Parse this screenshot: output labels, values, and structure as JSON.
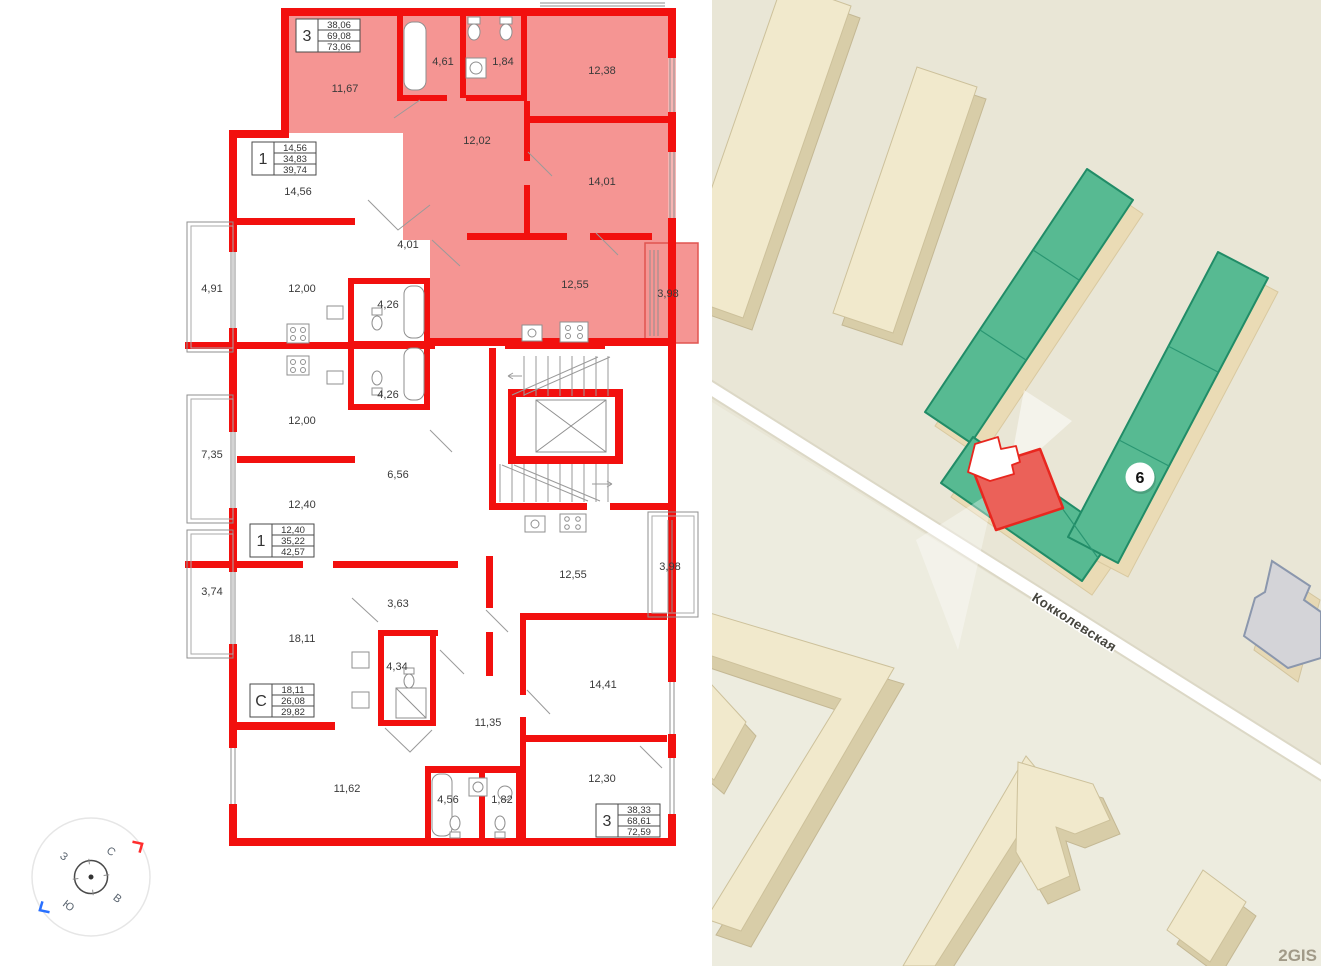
{
  "floorplan": {
    "colors": {
      "wall": "#f2100e",
      "selected_fill": "#f59593"
    },
    "summary_boxes": [
      {
        "type": "3",
        "rows": [
          "38,06",
          "69,08",
          "73,06"
        ]
      },
      {
        "type": "1",
        "rows": [
          "14,56",
          "34,83",
          "39,74"
        ]
      },
      {
        "type": "1",
        "rows": [
          "12,40",
          "35,22",
          "42,57"
        ]
      },
      {
        "type": "С",
        "rows": [
          "18,11",
          "26,08",
          "29,82"
        ]
      },
      {
        "type": "3",
        "rows": [
          "38,33",
          "68,61",
          "72,59"
        ]
      }
    ],
    "rooms": [
      "11,67",
      "4,61",
      "1,84",
      "12,38",
      "12,02",
      "14,01",
      "12,55",
      "3,98",
      "14,56",
      "4,91",
      "12,00",
      "4,01",
      "4,26",
      "4,26",
      "12,00",
      "7,35",
      "6,56",
      "12,40",
      "3,74",
      "18,11",
      "3,63",
      "4,34",
      "11,35",
      "12,55",
      "3,98",
      "14,41",
      "11,62",
      "4,56",
      "1,82",
      "12,30"
    ],
    "compass": {
      "north": "С",
      "east": "В",
      "south": "Ю",
      "west": "З"
    }
  },
  "map": {
    "street_label": "Кокколевская",
    "building_badge": "6",
    "watermark": "2GIS",
    "colors": {
      "background": "#e9e6d6",
      "building_top": "#f1e9cc",
      "building_side": "#d8cda8",
      "green_fill": "#57ba92",
      "green_border": "#218c67",
      "green_base": "#eadbb5",
      "highlight_fill": "#eb6159",
      "highlight_border": "#e8271f",
      "gray_building": "#d4d4d8",
      "gray_border": "#8b97ad"
    }
  }
}
